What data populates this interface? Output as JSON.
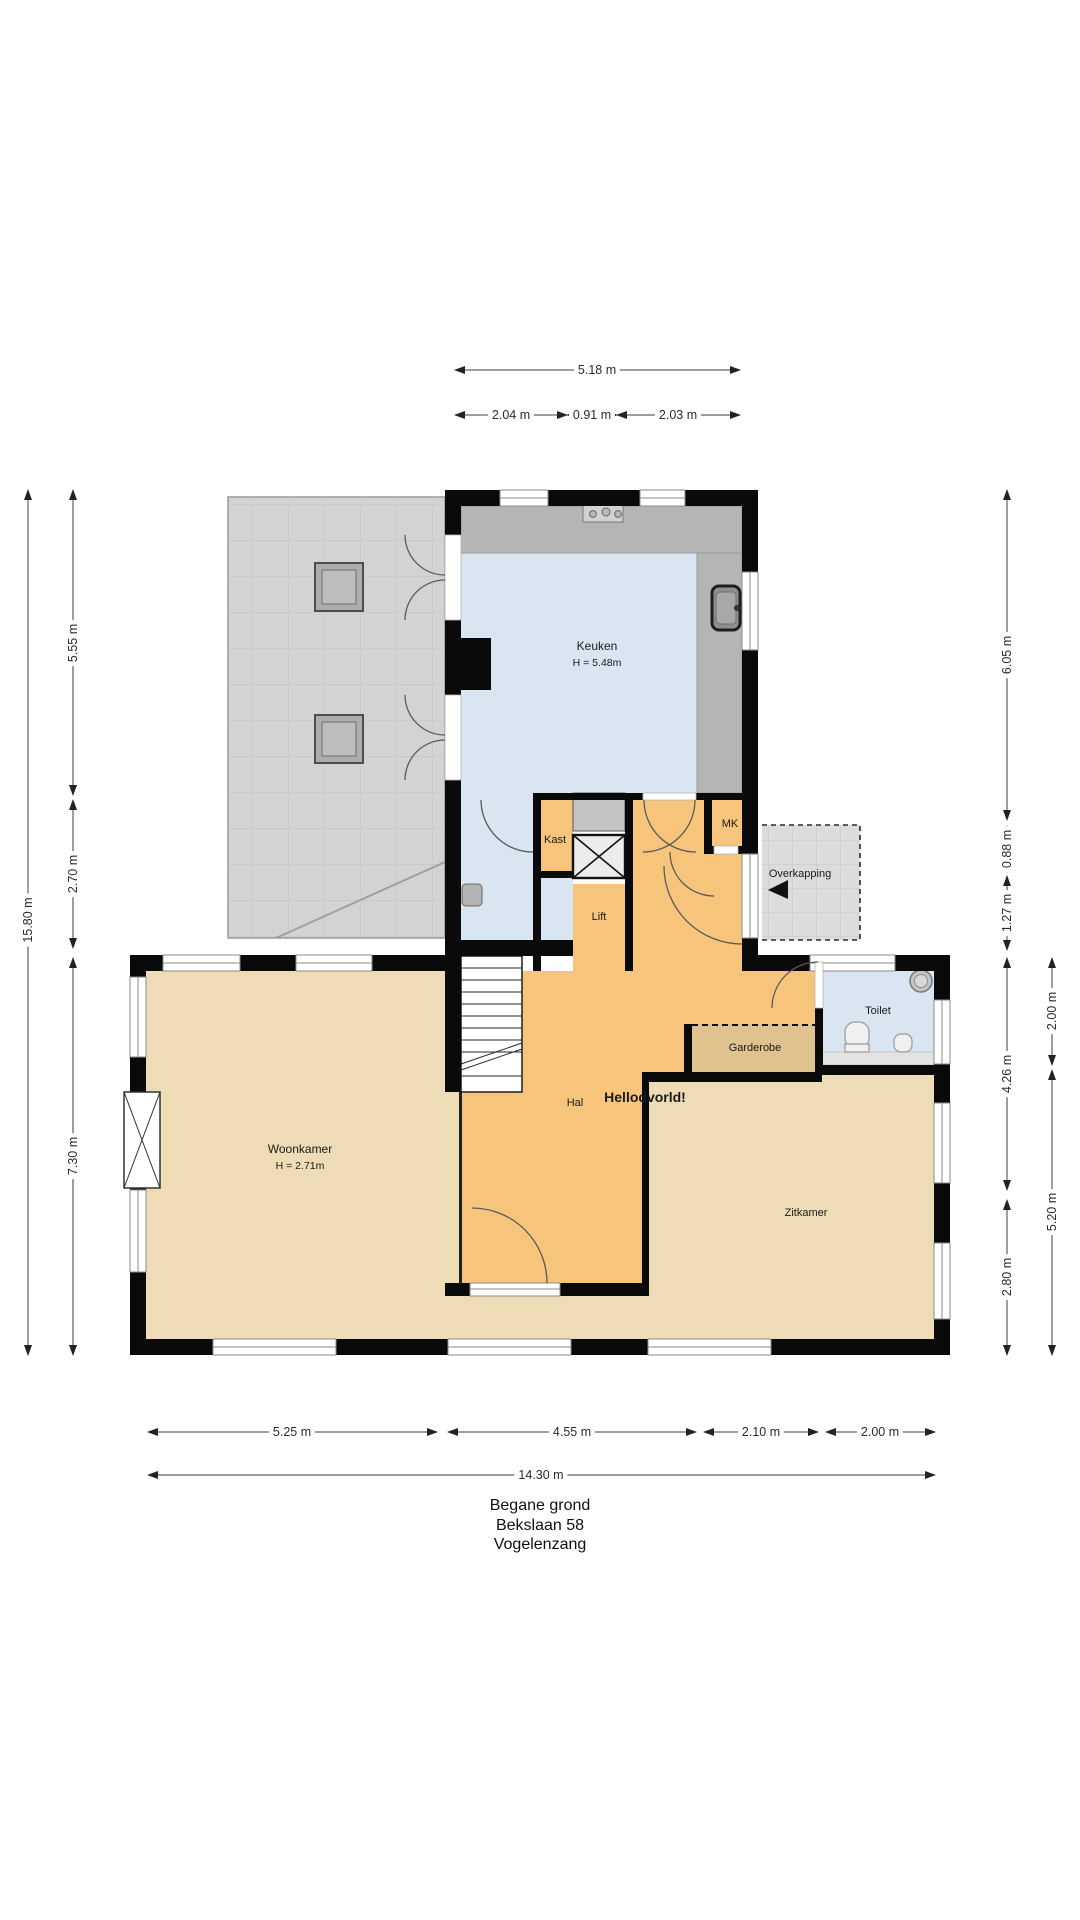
{
  "title": {
    "floor": "Begane grond",
    "street": "Bekslaan 58",
    "city": "Vogelenzang"
  },
  "rooms": {
    "keuken": {
      "label": "Keuken",
      "height": "H = 5.48m"
    },
    "kast": {
      "label": "Kast"
    },
    "mk": {
      "label": "MK"
    },
    "overkapping": {
      "label": "Overkapping"
    },
    "lift": {
      "label": "Lift"
    },
    "toilet": {
      "label": "Toilet"
    },
    "garderobe": {
      "label": "Garderobe"
    },
    "hal": {
      "label": "Hal"
    },
    "watermark": {
      "label": "Hellodvorld!"
    },
    "woonkamer": {
      "label": "Woonkamer",
      "height": "H = 2.71m"
    },
    "zitkamer": {
      "label": "Zitkamer"
    }
  },
  "dimensions": {
    "top": {
      "total": "5.18 m",
      "a": "2.04 m",
      "b": "0.91 m",
      "c": "2.03 m"
    },
    "left": {
      "total": "15.80 m",
      "a": "5.55 m",
      "b": "2.70 m",
      "c": "7.30 m"
    },
    "right": {
      "a": "6.05 m",
      "b": "0.88 m",
      "c": "1.27 m",
      "d": "4.26 m",
      "e": "2.80 m",
      "outer_a": "2.00 m",
      "outer_b": "5.20 m"
    },
    "bottom": {
      "a": "5.25 m",
      "b": "4.55 m",
      "c": "2.10 m",
      "d": "2.00 m",
      "total": "14.30 m"
    }
  },
  "colors": {
    "wall": "#0a0a0a",
    "orange": "#f6c57b",
    "tan": "#eddcb6",
    "tan-dark": "#dfc28e",
    "blue": "#d9e6f2",
    "terrace": "#d3d3d3",
    "counter": "#b5b5b5",
    "overkapping": "#dcdcdc",
    "dim": "#3c3c3c",
    "arc": "#5a5a5a",
    "text": "#1a1a1a"
  }
}
